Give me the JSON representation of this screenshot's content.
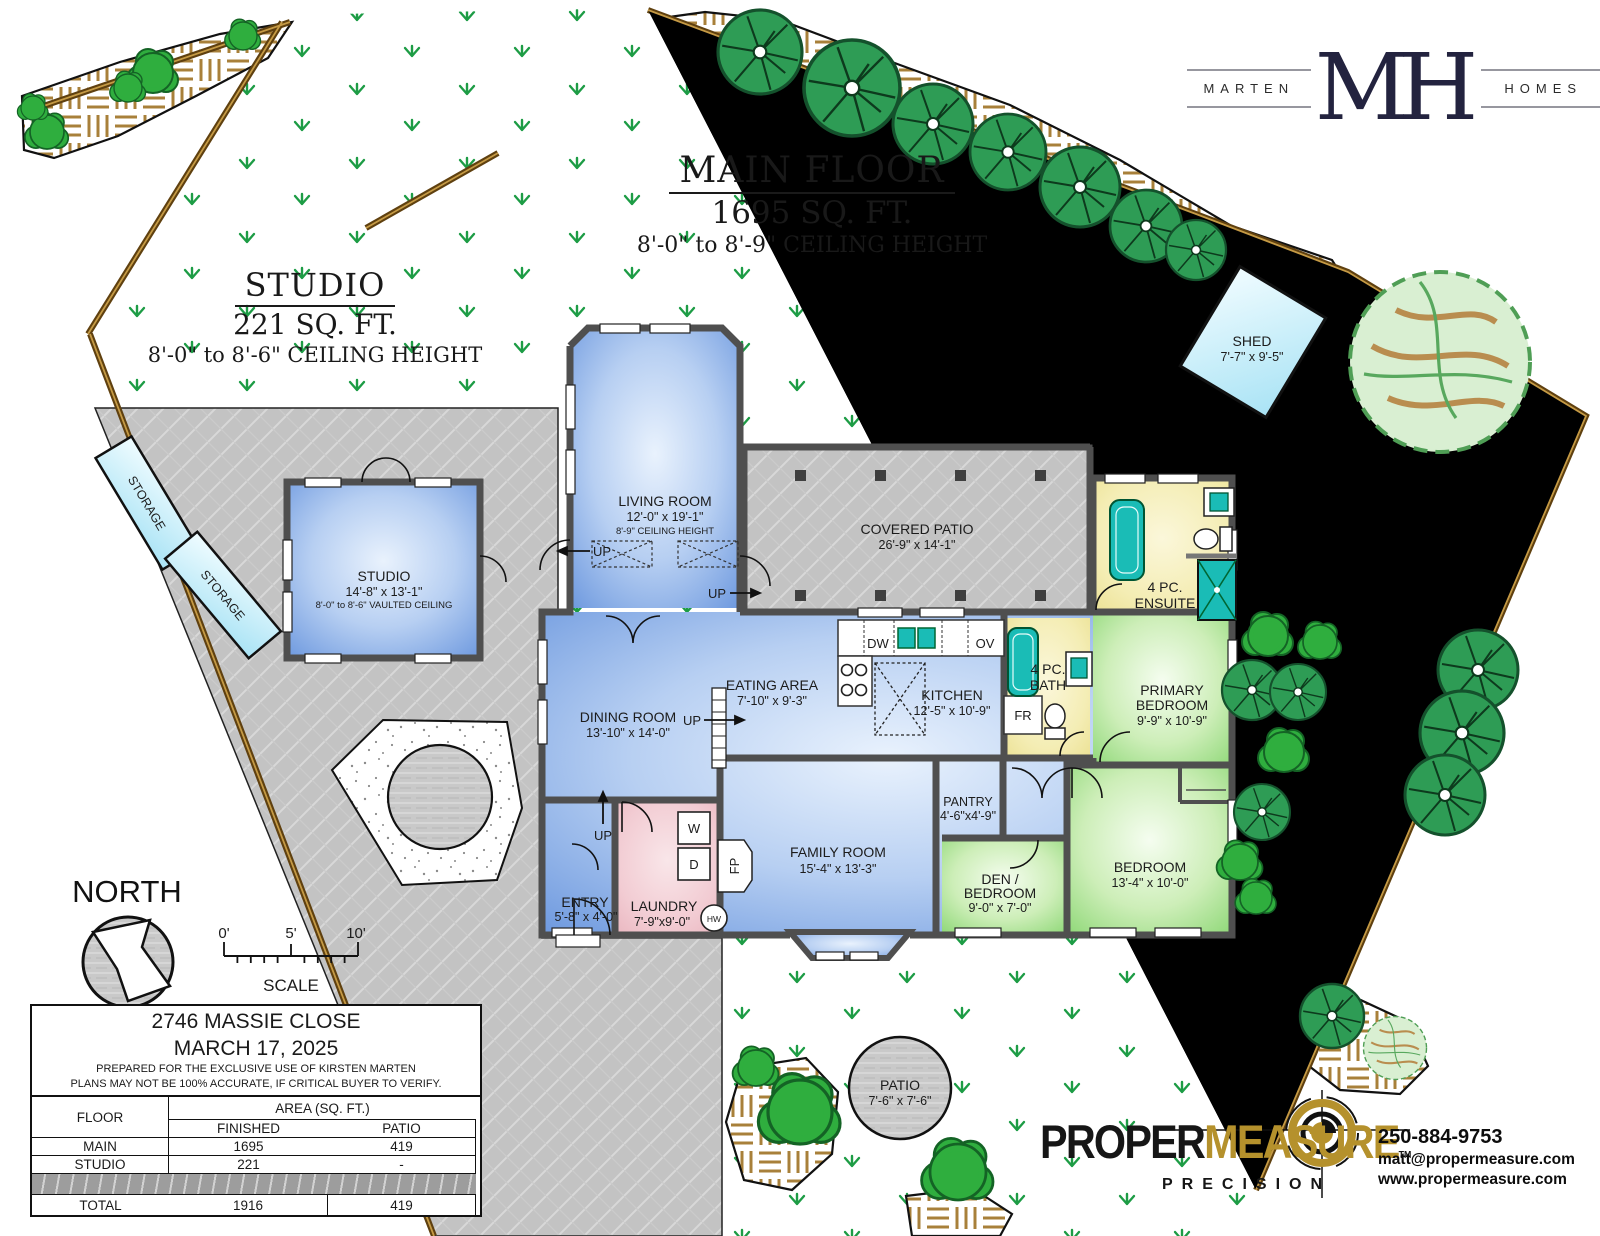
{
  "titles": {
    "main_floor": "MAIN FLOOR",
    "main_area": "1695 SQ. FT.",
    "main_ceiling": "8'-0\" to 8'-9\" CEILING HEIGHT",
    "studio": "STUDIO",
    "studio_area": "221 SQ. FT.",
    "studio_ceiling": "8'-0\" to 8'-6\" CEILING HEIGHT"
  },
  "brand": {
    "left": "MARTEN",
    "monogram": "MH",
    "right": "HOMES"
  },
  "rooms": {
    "living": {
      "name": "LIVING ROOM",
      "dims": "12'-0\" x 19'-1\"",
      "note": "8'-9\" CEILING HEIGHT"
    },
    "covered_patio": {
      "name": "COVERED PATIO",
      "dims": "26'-9\" x 14'-1\""
    },
    "studio": {
      "name": "STUDIO",
      "dims": "14'-8\" x 13'-1\"",
      "note": "8'-0\" to 8'-6\" VAULTED CEILING"
    },
    "dining": {
      "name": "DINING ROOM",
      "dims": "13'-10\" x 14'-0\""
    },
    "eating": {
      "name": "EATING AREA",
      "dims": "7'-10\" x 9'-3\""
    },
    "kitchen": {
      "name": "KITCHEN",
      "dims": "12'-5\" x 10'-9\""
    },
    "ensuite": {
      "line1": "4 PC.",
      "line2": "ENSUITE"
    },
    "bath": {
      "line1": "4 PC.",
      "line2": "BATH"
    },
    "primary": {
      "line1": "PRIMARY",
      "line2": "BEDROOM",
      "dims": "9'-9\" x 10'-9\""
    },
    "pantry": {
      "name": "PANTRY",
      "dims": "4'-6\"x4'-9\""
    },
    "den": {
      "line1": "DEN /",
      "line2": "BEDROOM",
      "dims": "9'-0\" x 7'-0\""
    },
    "bedroom": {
      "name": "BEDROOM",
      "dims": "13'-4\" x 10'-0\""
    },
    "family": {
      "name": "FAMILY ROOM",
      "dims": "15'-4\" x 13'-3\""
    },
    "laundry": {
      "name": "LAUNDRY",
      "dims": "7'-9\"x9'-0\""
    },
    "entry": {
      "name": "ENTRY",
      "dims": "5'-8\" x 4'-0\""
    }
  },
  "site": {
    "shed": {
      "name": "SHED",
      "dims": "7'-7\" x 9'-5\""
    },
    "patio": {
      "name": "PATIO",
      "dims": "7'-6\" x 7'-6\""
    },
    "storage_label": "STORAGE",
    "north": "NORTH",
    "scale": "SCALE",
    "scale_0": "0'",
    "scale_5": "5'",
    "scale_10": "10'"
  },
  "fixtures": {
    "dw": "DW",
    "ov": "OV",
    "fr": "FR",
    "washer": "W",
    "dryer": "D",
    "hw": "HW",
    "fp": "FP",
    "up": "UP"
  },
  "info_table": {
    "address": "2746 MASSIE CLOSE",
    "date": "MARCH 17, 2025",
    "prepared_for": "PREPARED FOR THE EXCLUSIVE USE OF KIRSTEN MARTEN",
    "disclaimer": "PLANS MAY NOT BE 100% ACCURATE, IF CRITICAL BUYER TO VERIFY.",
    "col_floor": "FLOOR",
    "col_area": "AREA (SQ. FT.)",
    "col_finished": "FINISHED",
    "col_patio": "PATIO",
    "rows": [
      {
        "floor": "MAIN",
        "finished": "1695",
        "patio": "419"
      },
      {
        "floor": "STUDIO",
        "finished": "221",
        "patio": "-"
      }
    ],
    "total": {
      "floor": "TOTAL",
      "finished": "1916",
      "patio": "419"
    }
  },
  "pm": {
    "word_black": "PROPER",
    "word_gold": "MEASURE",
    "tm": "TM",
    "tagline": "PRECISION"
  },
  "contact": {
    "phone": "250-884-9753",
    "email": "matt@propermeasure.com",
    "web": "www.propermeasure.com"
  },
  "colors": {
    "brand_navy": "#23233f",
    "pm_gold": "#b5912c",
    "fixture_teal": "#1abcb6",
    "grass_green": "#1d9c45",
    "bed_tan": "#a8803a",
    "wall_gray": "#4f4f4f"
  }
}
